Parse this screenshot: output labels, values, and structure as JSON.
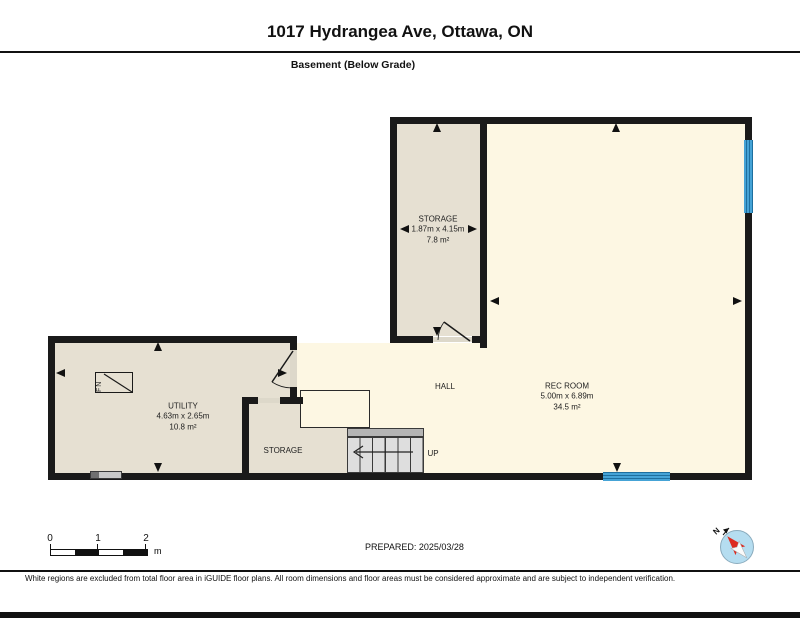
{
  "header": {
    "title": "1017 Hydrangea Ave, Ottawa, ON",
    "subtitle": "Basement (Below Grade)"
  },
  "rooms": [
    {
      "name": "STORAGE",
      "dims": "1.87m x 4.15m",
      "area": "7.8 m²"
    },
    {
      "name": "UTILITY",
      "dims": "4.63m x 2.65m",
      "area": "10.8 m²"
    },
    {
      "name": "REC ROOM",
      "dims": "5.00m x 6.89m",
      "area": "34.5 m²"
    },
    {
      "name": "HALL"
    },
    {
      "name": "STORAGE"
    }
  ],
  "stairs": {
    "direction_label": "UP"
  },
  "fixtures": {
    "furnace_label": "FN"
  },
  "compass": {
    "north_label": "N"
  },
  "scale_bar": {
    "ticks": [
      "0",
      "1",
      "2"
    ],
    "unit": "m"
  },
  "prepared_label": "PREPARED: 2025/03/28",
  "disclaimer": "White regions are excluded from total floor area in iGUIDE floor plans. All room dimensions and floor areas must be considered approximate and are subject to independent verification.",
  "colors": {
    "wall": "#1a1a1a",
    "room_shaded": "#e6e0d2",
    "room_open": "#fdf7e3",
    "window_blue": "#45a3d6",
    "compass_red": "#dd2b20"
  }
}
